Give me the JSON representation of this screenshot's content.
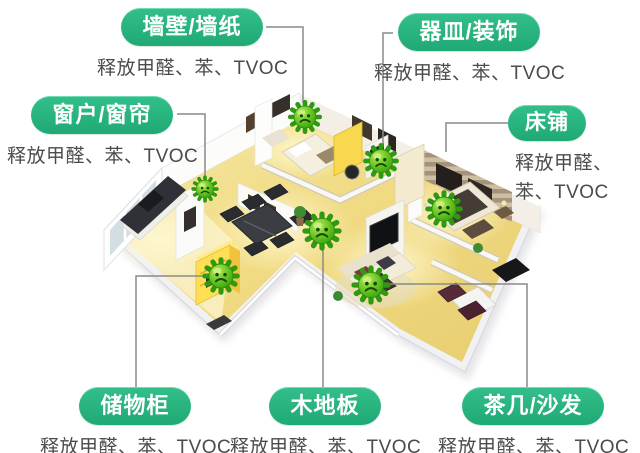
{
  "scene": {
    "background": "#ffffff",
    "illustration": "isometric-3d-apartment-cutaway-render",
    "topic": "indoor formaldehyde / VOC emission sources"
  },
  "palette": {
    "label_green": "#27b47f",
    "label_text": "#ffffff",
    "desc_text": "#4b4b4b",
    "connector_gray": "#8a8a8a",
    "germ_green": "#54bd1c",
    "floor_yellow": "#f0da82"
  },
  "callouts": [
    {
      "id": "wall-wallpaper",
      "title": "墙壁/墙纸",
      "desc": "释放甲醛、苯、TVOC"
    },
    {
      "id": "dishware-decor",
      "title": "器皿/装饰",
      "desc": "释放甲醛、苯、TVOC"
    },
    {
      "id": "window-curtain",
      "title": "窗户/窗帘",
      "desc": "释放甲醛、苯、TVOC"
    },
    {
      "id": "bedding",
      "title": "床铺",
      "desc_line1": "释放甲醛、",
      "desc_line2": "苯、TVOC"
    },
    {
      "id": "storage-cabinet",
      "title": "储物柜",
      "desc": "释放甲醛、苯、TVOC"
    },
    {
      "id": "wood-floor",
      "title": "木地板",
      "desc": "释放甲醛、苯、TVOC"
    },
    {
      "id": "coffee-table-sofa",
      "title": "茶几/沙发",
      "desc": "释放甲醛、苯、TVOC"
    }
  ],
  "germ_markers": {
    "icon": "germ-icon",
    "count": 7
  }
}
